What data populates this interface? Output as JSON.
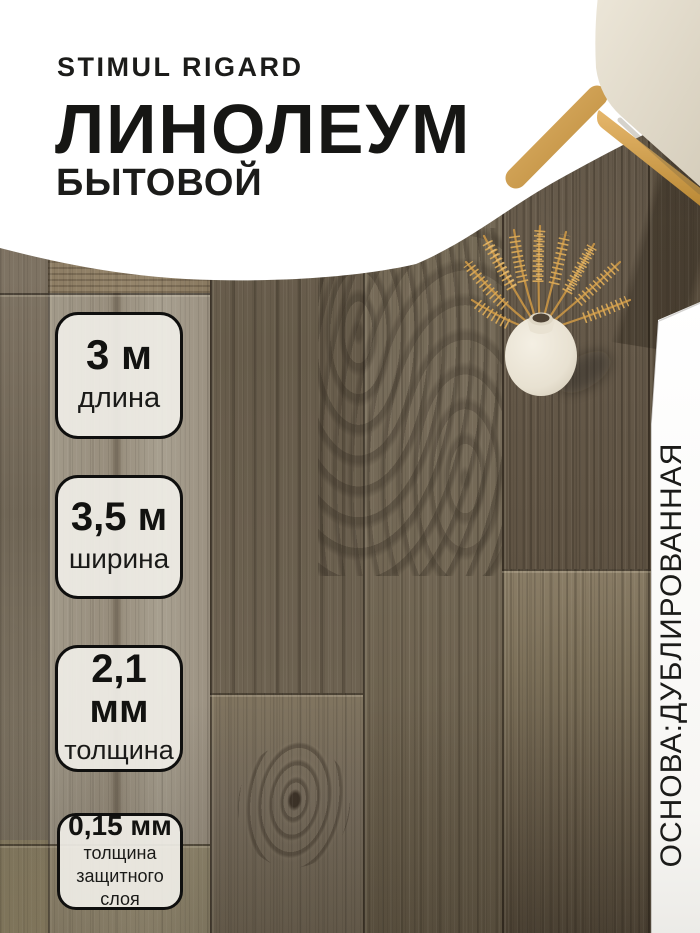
{
  "header": {
    "brand": "STIMUL RIGARD",
    "title": "ЛИНОЛЕУМ",
    "subtitle": "БЫТОВОЙ"
  },
  "badges": [
    {
      "value": "3 м",
      "label": "длина"
    },
    {
      "value": "3,5 м",
      "label": "ширина"
    },
    {
      "value": "2,1 мм",
      "label": "толщина"
    },
    {
      "value": "0,15 мм",
      "label": "толщина защитного слоя"
    }
  ],
  "side_banner": {
    "text": "ОСНОВА:ДУБЛИРОВАННАЯ"
  },
  "scene": {
    "photo_elements": [
      "wood-plank-linoleum-floor",
      "chair-corner",
      "ceramic-vase",
      "dried-wheat-stems"
    ]
  },
  "colors": {
    "text": "#1a1a18",
    "background_white": "#ffffff",
    "badge_fill": "rgba(240,238,231,0.92)",
    "badge_border": "#0f0f0e",
    "wood_dark": "#5f5343",
    "wood_mid": "#776c5a",
    "wood_light": "#9c9283",
    "wheat": "#d9a958",
    "chair_wood": "#d2a051",
    "cushion": "#e7e1d2"
  }
}
